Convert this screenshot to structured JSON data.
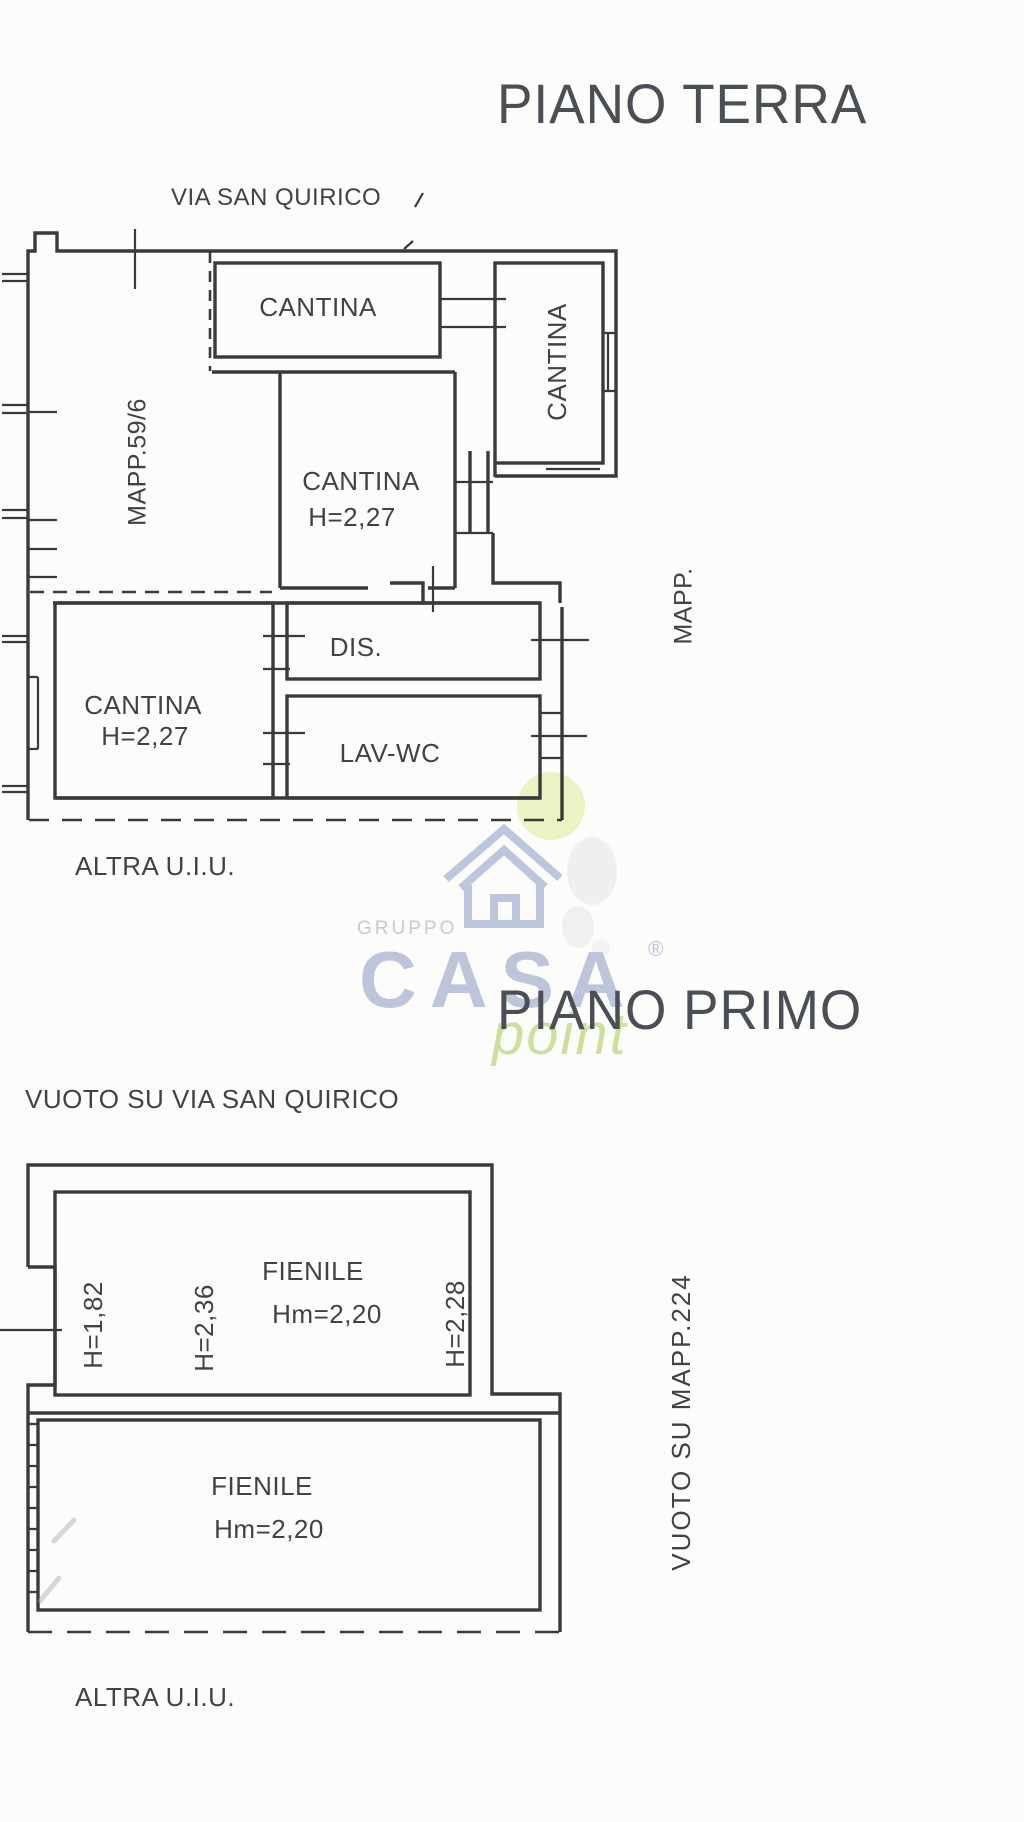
{
  "ground_floor": {
    "title": "PIANO TERRA",
    "street_label": "VIA SAN QUIRICO",
    "parcel_left": "MAPP.59/6",
    "parcel_right": "MAPP.",
    "other_unit": "ALTRA U.I.U.",
    "rooms": {
      "cantina_top": {
        "label": "CANTINA"
      },
      "cantina_right": {
        "label": "CANTINA"
      },
      "cantina_middle": {
        "label": "CANTINA",
        "height": "H=2,27"
      },
      "dis": {
        "label": "DIS."
      },
      "lav_wc": {
        "label": "LAV-WC"
      },
      "cantina_left": {
        "label": "CANTINA",
        "height": "H=2,27"
      }
    }
  },
  "first_floor": {
    "title": "PIANO PRIMO",
    "void_street_label": "VUOTO SU VIA SAN QUIRICO",
    "void_parcel_label": "VUOTO SU MAPP.224",
    "other_unit": "ALTRA U.I.U.",
    "rooms": {
      "fienile_top": {
        "label": "FIENILE",
        "mean_height": "Hm=2,20",
        "wall_heights": {
          "left": "H=1,82",
          "middle": "H=2,36",
          "right": "H=2,28"
        }
      },
      "fienile_bottom": {
        "label": "FIENILE",
        "mean_height": "Hm=2,20"
      }
    }
  },
  "watermark": {
    "group": "GRUPPO",
    "brand": "CASA",
    "registered": "®",
    "sub_brand": "point"
  },
  "colors": {
    "plan_line": "#3a3a3a",
    "title_text": "#4a4e55",
    "watermark_blue": "#b9c3d9",
    "watermark_green": "#c9de92",
    "watermark_gray": "#c9c9c9",
    "watermark_circle": "#e9f2bf"
  }
}
